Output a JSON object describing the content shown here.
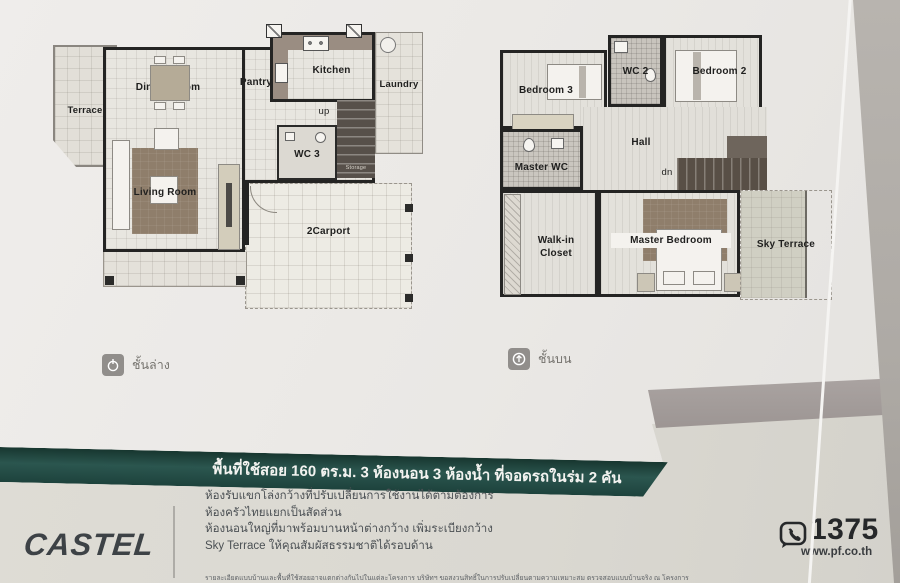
{
  "floor1": {
    "caption": "ชั้นล่าง",
    "rooms": {
      "terrace": "Terrace",
      "dining": "Dining Room",
      "pantry": "Pantry",
      "kitchen": "Kitchen",
      "laundry": "Laundry",
      "up": "up",
      "wc3": "WC 3",
      "storage": "Storage",
      "living": "Living Room",
      "carport": "2Carport"
    }
  },
  "floor2": {
    "caption": "ชั้นบน",
    "rooms": {
      "bedroom3": "Bedroom 3",
      "wc2": "WC 2",
      "bedroom2": "Bedroom 2",
      "master_wc": "Master WC",
      "hall": "Hall",
      "dn": "dn",
      "walkin_line1": "Walk-in",
      "walkin_line2": "Closet",
      "master_bedroom": "Master Bedroom",
      "sky_terrace": "Sky Terrace"
    }
  },
  "banner": {
    "text": "พื้นที่ใช้สอย 160 ตร.ม.  3 ห้องนอน 3 ห้องน้ำ ที่จอดรถในร่ม 2 คัน",
    "bg_color": "#24504a"
  },
  "footer": {
    "brand": "CASTEL",
    "features": [
      "ห้องรับแขกโล่งกว้างที่ปรับเปลี่ยนการใช้งานได้ตามต้องการ",
      "ห้องครัวไทยแยกเป็นสัดส่วน",
      "ห้องนอนใหญ่ที่มาพร้อมบานหน้าต่างกว้าง เพิ่มระเบียงกว้าง",
      "Sky Terrace ให้คุณสัมผัสธรรมชาติได้รอบด้าน"
    ],
    "disclaimer": "รายละเอียดแบบบ้านและพื้นที่ใช้สอยอาจแตกต่างกันไปในแต่ละโครงการ บริษัทฯ ขอสงวนสิทธิ์ในการปรับเปลี่ยนตามความเหมาะสม ตรวจสอบแบบบ้านจริง ณ โครงการ",
    "phone": "1375",
    "website": "www.pf.co.th"
  },
  "icons": {
    "lower_floor": "floor-lower-icon",
    "upper_floor": "floor-upper-icon",
    "phone": "phone-bubble-icon"
  },
  "colors": {
    "page_top": "#ebe9e6",
    "page_bottom": "#dcdad3",
    "banner_teal": "#24504a",
    "diagonal_band": "#a39c9a",
    "wall": "#242423",
    "rug_brown": "#8f7e6b",
    "stairs_dark": "#57504a",
    "table_edge": "#b2aea9"
  }
}
